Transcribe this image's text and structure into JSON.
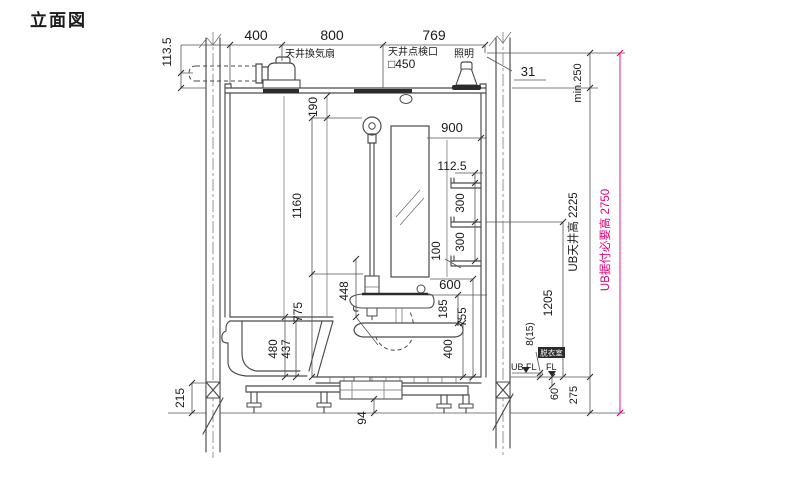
{
  "title": "立面図",
  "colors": {
    "line": "#4a4a4a",
    "dark_fill": "#2b2b2b",
    "accent_pink": "#e4007f",
    "text": "#1a1a1a",
    "background": "#ffffff"
  },
  "top": {
    "dim_400": "400",
    "dim_800": "800",
    "dim_769": "769",
    "dim_31": "31",
    "dim_113_5": "113.5",
    "vent_fan_label": "天井換気扇",
    "inspection_port_label": "天井点検口",
    "inspection_port_size": "□450",
    "light_label": "照明",
    "min_clearance": "min.250"
  },
  "interior": {
    "head_offset": "190",
    "slide_bar": "1160",
    "bar_to_floor": "775",
    "hose": "448",
    "tub_rim": "480",
    "tub_depth": "437",
    "mirror_line": "900",
    "shelf_offset": "112.5",
    "shelf_pitch_a": "300",
    "shelf_pitch_b": "300",
    "shelf_gap": "100",
    "counter_line": "600",
    "spout_gap": "185",
    "panel_strip": "755",
    "counter_height": "400"
  },
  "base": {
    "wall_base": "215",
    "drain_gap": "94",
    "floor_step": "8(15)",
    "ub_floor": "UB.FL",
    "floor": "FL",
    "room": "脱衣室",
    "floor_gap": "60",
    "base_height": "275"
  },
  "right": {
    "ceiling_height": "UB天井高 2225",
    "opening": "1205",
    "required": "UB据付必要高 2750"
  }
}
